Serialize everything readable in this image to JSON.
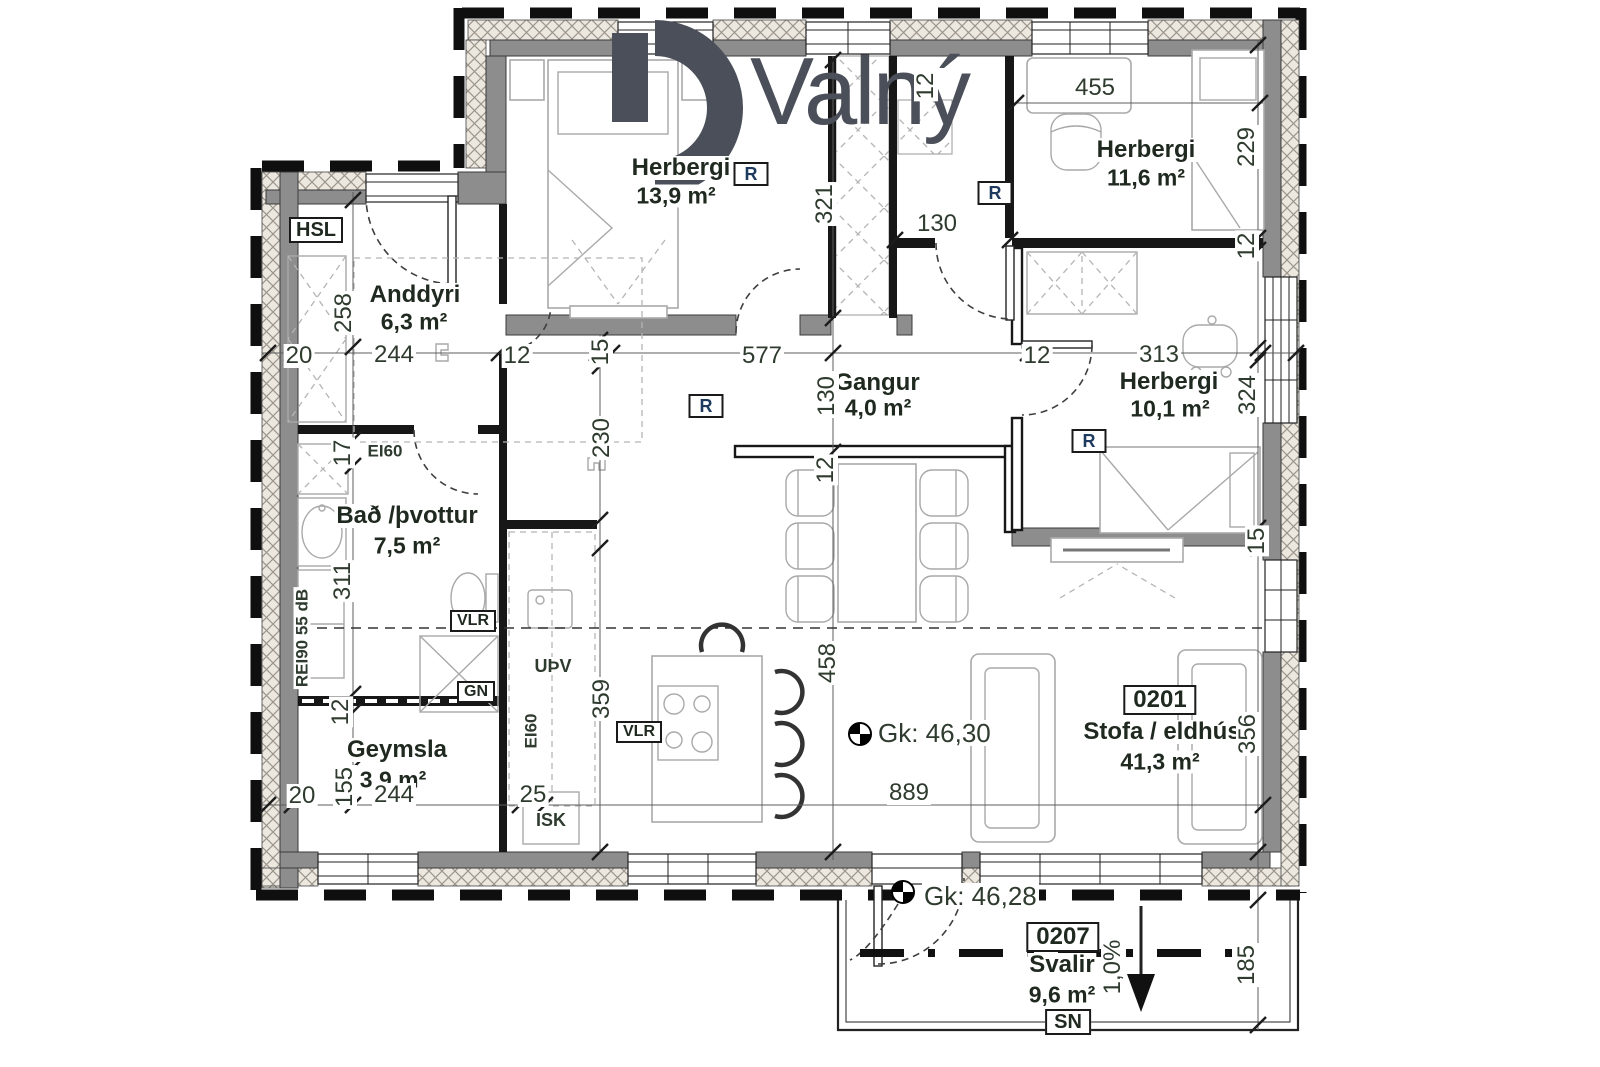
{
  "logo": {
    "text": "Valný"
  },
  "rooms": {
    "herbergi_139": {
      "name": "Herbergi",
      "area": "13,9 m²"
    },
    "herbergi_116": {
      "name": "Herbergi",
      "area": "11,6 m²"
    },
    "herbergi_101": {
      "name": "Herbergi",
      "area": "10,1 m²"
    },
    "anddyri": {
      "name": "Anddyri",
      "area": "6,3 m²"
    },
    "gangur": {
      "name": "Gangur",
      "area": "4,0 m²"
    },
    "bad_thvottur": {
      "name": "Bað /þvottur",
      "area": "7,5 m²"
    },
    "geymsla": {
      "name": "Geymsla",
      "area": "3,9 m²"
    },
    "stofa_eldhus": {
      "name": "Stofa / eldhús",
      "area": "41,3 m²",
      "unit": "0201"
    },
    "svalir": {
      "name": "Svalir",
      "area": "9,6 m²",
      "unit": "0207",
      "slope": "1,0%",
      "orientation": "SN"
    }
  },
  "levels": {
    "main_floor": "Gk: 46,30",
    "balcony": "Gk: 46,28"
  },
  "tags": {
    "hsl": "HSL",
    "ei60": "EI60",
    "rei90": "REI90 55 dB",
    "vlr": "VLR",
    "gn": "GN",
    "upv": "UÞV",
    "isk": "ISK",
    "radiator": "R"
  },
  "dims": {
    "d20": "20",
    "d244": "244",
    "d12": "12",
    "d15": "15",
    "d577": "577",
    "d313": "313",
    "d258": "258",
    "d321": "321",
    "d229": "229",
    "d324": "324",
    "d230": "230",
    "d130": "130",
    "d17": "17",
    "d311": "311",
    "d155": "155",
    "d359": "359",
    "d458": "458",
    "d356": "356",
    "d185": "185",
    "d455": "455",
    "d25": "25",
    "d889": "889"
  },
  "colors": {
    "logo": "#4b4f5a",
    "wall_gray": "#8d8d8d",
    "label_green": "#2e3b2e"
  }
}
